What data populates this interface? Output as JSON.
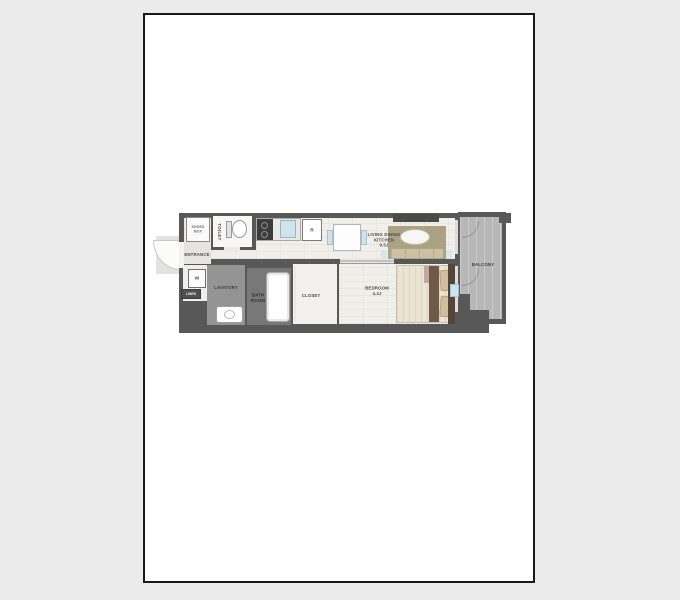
{
  "window": {
    "background": "#ebebeb"
  },
  "card": {
    "background": "#ffffff",
    "border_color": "#1a1a1a"
  },
  "floorplan": {
    "type": "apartment-floor-plan",
    "labels": {
      "entrance": "ENTRANCE",
      "toilet": "TOILET",
      "shoes_box": {
        "line1": "SHOES",
        "line2": "BOX"
      },
      "washer": "W",
      "linen": "LINEN",
      "lavatory": "LAVATORY",
      "bath_room": {
        "line1": "BATH",
        "line2": "ROOM"
      },
      "closet": "CLOSET",
      "bedroom": {
        "name": "BEDROOM",
        "size": "4.4J"
      },
      "living_dining_kitchen": {
        "line1": "LIVING DINING",
        "line2": "KITCHEN",
        "size": "9.5J"
      },
      "balcony": "BALCONY",
      "refrigerator": "R"
    },
    "colors": {
      "wall": "#585858",
      "floor_wood": "#f1efe9",
      "floor_entry_tile": "#e6e4e0",
      "floor_toilet": "#f8f7f5",
      "floor_closet": "#f3f1ed",
      "floor_lavatory": "#949494",
      "floor_bath": "#787878",
      "floor_balcony": "#b7b7b7",
      "porch": "#e2e2e2",
      "rug": "#aca283",
      "sofa": "#cdc1a5",
      "table": "#ffffff",
      "accent_blue": "#cfe3ec",
      "bed_duvet": "#ebe4d5",
      "bed_band": "#6f5a48",
      "bed_mauve": "#c2a7a1",
      "bed_pillow": "#d3bd9c",
      "bed_headboard": "#54453a",
      "tv_board": "#4a4a4a",
      "stove": "#3c3c3c"
    }
  }
}
